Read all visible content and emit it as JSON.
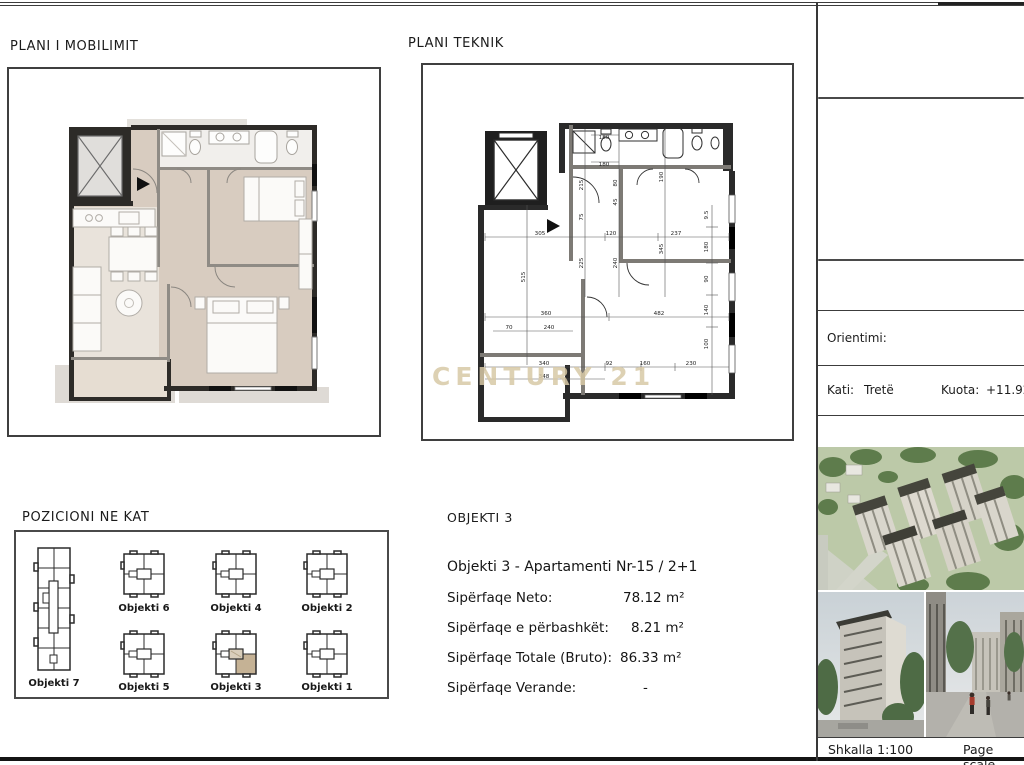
{
  "titles": {
    "plani_mobilimit": "PLANI I MOBILIMIT",
    "plani_teknik": "PLANI TEKNIK",
    "pozicioni": "POZICIONI NE KAT",
    "objekti_header": "OBJEKTI 3"
  },
  "apartment": {
    "name": "Objekti 3 - Apartamenti Nr-15 / 2+1",
    "rows": [
      {
        "label": "Sipërfaqe Neto:",
        "value": "78.12 m²"
      },
      {
        "label": "Sipërfaqe e përbashkët:",
        "value": "8.21 m²"
      },
      {
        "label": "Sipërfaqe Totale (Bruto):",
        "value": "86.33  m²"
      },
      {
        "label": "Sipërfaqe Verande:",
        "value": "-"
      }
    ]
  },
  "title_block": {
    "orientimi_label": "Orientimi:",
    "kati_label": "Kati:",
    "kati_value": "Tretë",
    "kuota_label": "Kuota:",
    "kuota_value": "+11.92",
    "shkalla": "Shkalla 1:100",
    "page_scale": "Page scale"
  },
  "position_items": [
    {
      "label": "Objekti 7",
      "highlighted": false
    },
    {
      "label": "Objekti 6",
      "highlighted": false
    },
    {
      "label": "Objekti 4",
      "highlighted": false
    },
    {
      "label": "Objekti 2",
      "highlighted": false
    },
    {
      "label": "Objekti 5",
      "highlighted": false
    },
    {
      "label": "Objekti 3",
      "highlighted": true
    },
    {
      "label": "Objekti 1",
      "highlighted": false
    }
  ],
  "watermark": {
    "text": "CENTURY 21"
  },
  "technical_plan": {
    "dimensions": [
      {
        "t": "305",
        "x": 117,
        "y": 170
      },
      {
        "t": "120",
        "x": 188,
        "y": 170
      },
      {
        "t": "237",
        "x": 253,
        "y": 170
      },
      {
        "t": "515",
        "x": 102,
        "y": 212,
        "v": 1
      },
      {
        "t": "215",
        "x": 160,
        "y": 120,
        "v": 1
      },
      {
        "t": "75",
        "x": 160,
        "y": 152,
        "v": 1
      },
      {
        "t": "225",
        "x": 160,
        "y": 198,
        "v": 1
      },
      {
        "t": "80",
        "x": 194,
        "y": 118,
        "v": 1
      },
      {
        "t": "45",
        "x": 194,
        "y": 137,
        "v": 1
      },
      {
        "t": "240",
        "x": 194,
        "y": 198,
        "v": 1
      },
      {
        "t": "190",
        "x": 240,
        "y": 112,
        "v": 1
      },
      {
        "t": "345",
        "x": 240,
        "y": 184,
        "v": 1
      },
      {
        "t": "180",
        "x": 181,
        "y": 74
      },
      {
        "t": "180",
        "x": 181,
        "y": 101
      },
      {
        "t": "9.5",
        "x": 285,
        "y": 150,
        "v": 1
      },
      {
        "t": "180",
        "x": 285,
        "y": 182,
        "v": 1
      },
      {
        "t": "90",
        "x": 285,
        "y": 214,
        "v": 1
      },
      {
        "t": "140",
        "x": 285,
        "y": 245,
        "v": 1
      },
      {
        "t": "100",
        "x": 285,
        "y": 279,
        "v": 1
      },
      {
        "t": "360",
        "x": 123,
        "y": 250
      },
      {
        "t": "482",
        "x": 236,
        "y": 250
      },
      {
        "t": "70",
        "x": 86,
        "y": 264
      },
      {
        "t": "240",
        "x": 126,
        "y": 264
      },
      {
        "t": "340",
        "x": 121,
        "y": 300
      },
      {
        "t": "348",
        "x": 121,
        "y": 313
      },
      {
        "t": "92",
        "x": 186,
        "y": 300
      },
      {
        "t": "160",
        "x": 222,
        "y": 300
      },
      {
        "t": "230",
        "x": 268,
        "y": 300
      }
    ]
  },
  "colors": {
    "floor_beige": "#d8ccc0",
    "floor_light": "#e9e3db",
    "wall_dark": "#2d2b28",
    "wall_gray": "#8f8b85",
    "highlight_tan": "#c5b295",
    "watermark_gold": "#d8c9a6"
  }
}
